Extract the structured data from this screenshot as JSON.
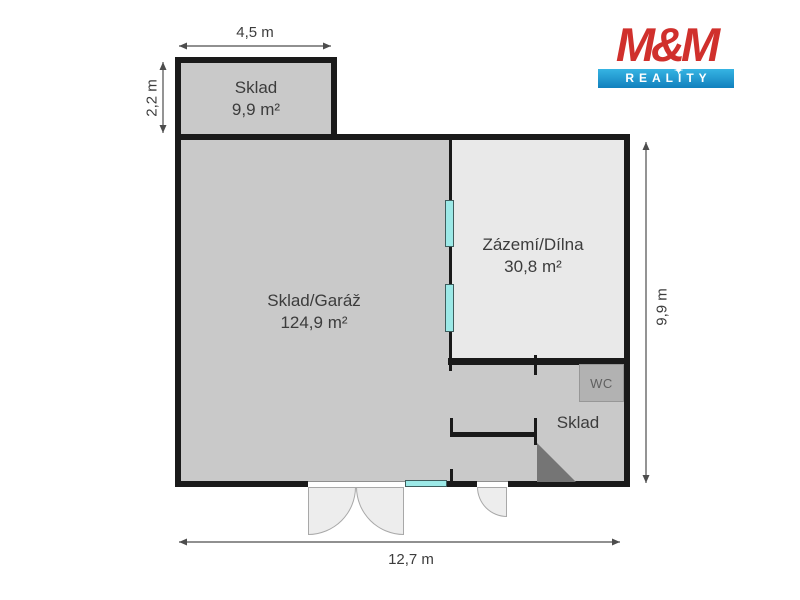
{
  "logo": {
    "name": "M&M",
    "tagline": "REALITY"
  },
  "icons": {
    "star": "✦"
  },
  "rooms": {
    "annex": {
      "name": "Sklad",
      "area": "9,9 m²"
    },
    "garage": {
      "name": "Sklad/Garáž",
      "area": "124,9 m²"
    },
    "workshop": {
      "name": "Zázemí/Dílna",
      "area": "30,8 m²"
    },
    "storage": {
      "name": "Sklad"
    },
    "wc": {
      "name": "WC"
    }
  },
  "dimensions": {
    "top": "4,5 m",
    "left": "2,2 m",
    "right": "9,9 m",
    "bottom": "12,7 m"
  },
  "colors": {
    "wall": "#1a1a1a",
    "room_fill": "#c9c9c9",
    "workshop_fill": "#e9e9e9",
    "wc_fill": "#b2b2b2",
    "window": "#9ce9e7",
    "stairs": "#757575",
    "logo_red": "#d0302c",
    "logo_blue": "#1180bd",
    "dimension_line": "#4d4d4d"
  }
}
